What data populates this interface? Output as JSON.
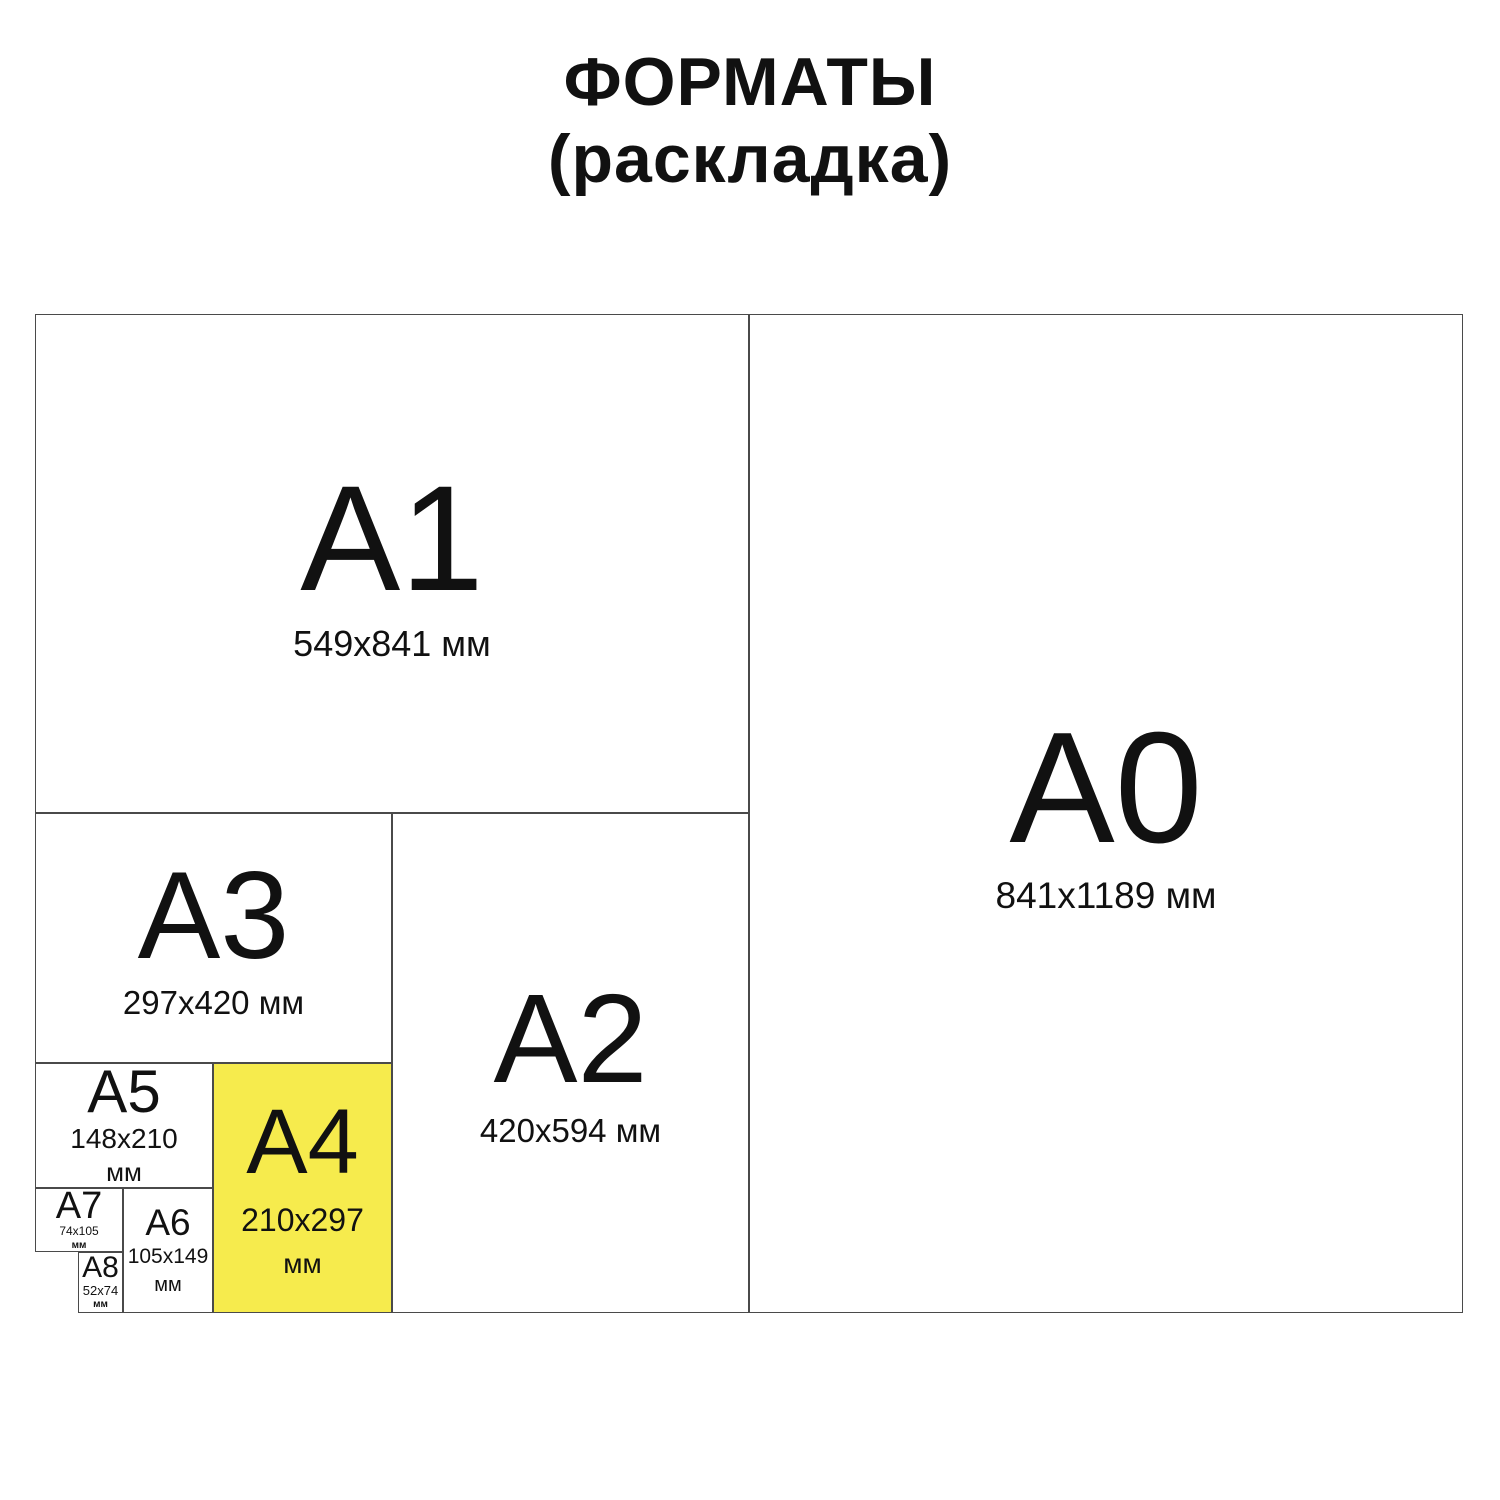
{
  "title": {
    "line1": "ФОРМАТЫ",
    "line2": "(раскладка)"
  },
  "colors": {
    "highlight": "#F6EB4D",
    "line": "#4a4a4a",
    "text": "#111111",
    "background": "#ffffff"
  },
  "formats": {
    "a1": {
      "label": "A1",
      "size": "549x841 мм",
      "highlighted": false
    },
    "a0": {
      "label": "A0",
      "size": "841x1189 мм",
      "highlighted": false
    },
    "a3": {
      "label": "A3",
      "size": "297x420 мм",
      "highlighted": false
    },
    "a2": {
      "label": "A2",
      "size": "420x594 мм",
      "highlighted": false
    },
    "a5": {
      "label": "A5",
      "size": "148x210",
      "unit": "мм",
      "highlighted": false
    },
    "a4": {
      "label": "A4",
      "size": "210x297",
      "unit": "мм",
      "highlighted": true
    },
    "a7": {
      "label": "A7",
      "size": "74x105",
      "unit": "мм",
      "highlighted": false
    },
    "a6": {
      "label": "A6",
      "size": "105x149",
      "unit": "мм",
      "highlighted": false
    },
    "a8": {
      "label": "A8",
      "size": "52x74",
      "unit": "мм",
      "highlighted": false
    }
  }
}
